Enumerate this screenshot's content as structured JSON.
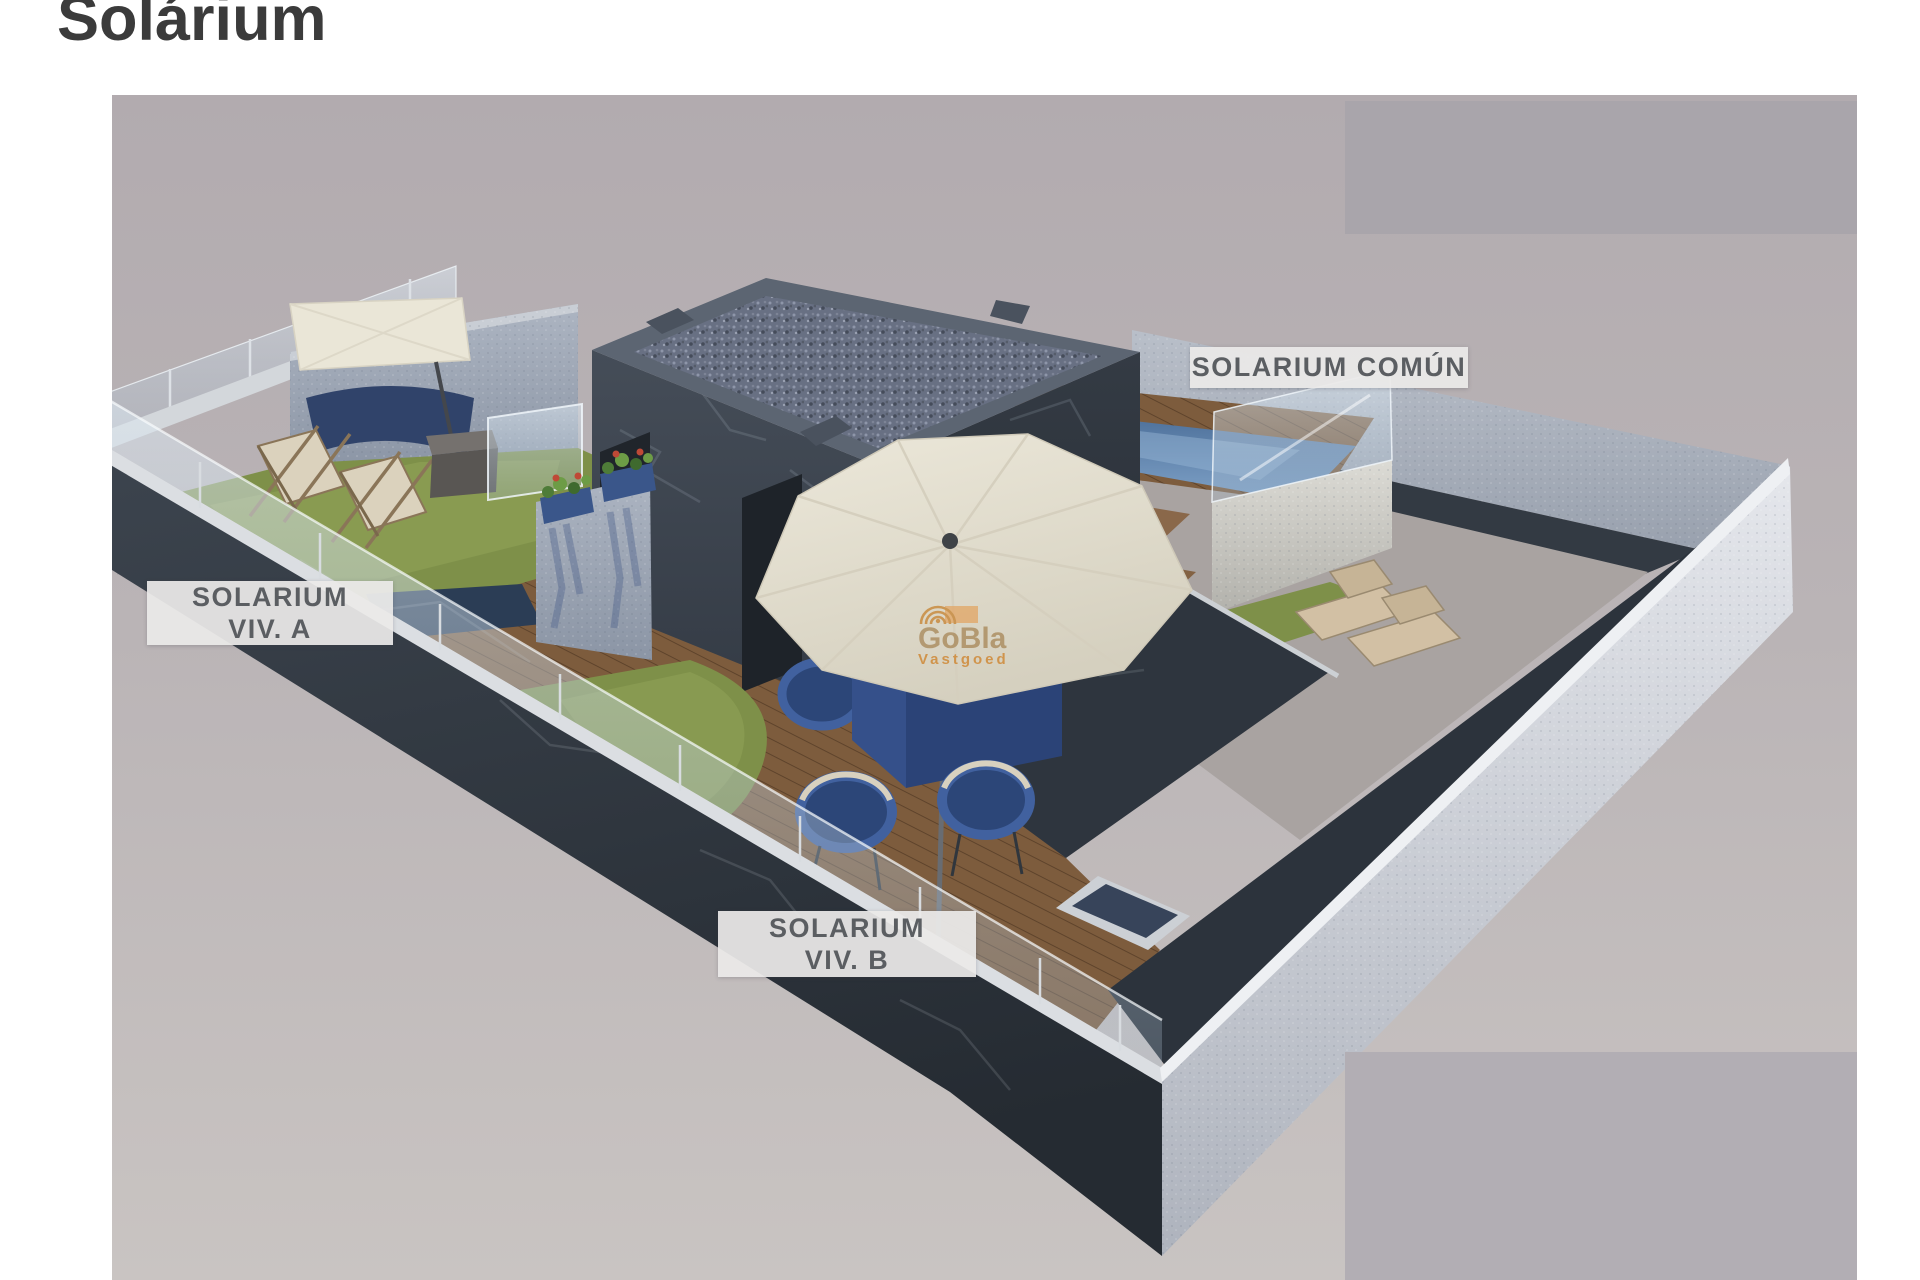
{
  "page": {
    "title": "Solárium"
  },
  "render": {
    "labels": {
      "comun": {
        "text": "SOLARIUM COMÚN"
      },
      "viv_a": {
        "line1": "SOLARIUM",
        "line2": "VIV. A"
      },
      "viv_b": {
        "line1": "SOLARIUM",
        "line2": "VIV. B"
      }
    },
    "watermark": {
      "brand": "GoBla",
      "sub": "Vastgoed",
      "logo_icon": "concentric-arcs-sun-icon"
    },
    "colors": {
      "title_text": "#3b3b3b",
      "label_text": "#5b5e62",
      "label_bg": "#ebeae8",
      "watermark_tan": "#ab8d60",
      "watermark_orange": "#cf8733",
      "backdrop": "#bab4b6",
      "redacted_box": "#aba7ad",
      "dark_marble_wall": "#333a43",
      "light_wall": "#d9dce2",
      "stucco_wall": "#9aa3b2",
      "grass": "#7e9049",
      "deck_wood": "#7d5c3d",
      "pool_water": "#6b8fba",
      "gravel_roof": "#687083",
      "furniture_blue": "#3a5590",
      "canopy_cream": "#e9e5d6"
    }
  }
}
